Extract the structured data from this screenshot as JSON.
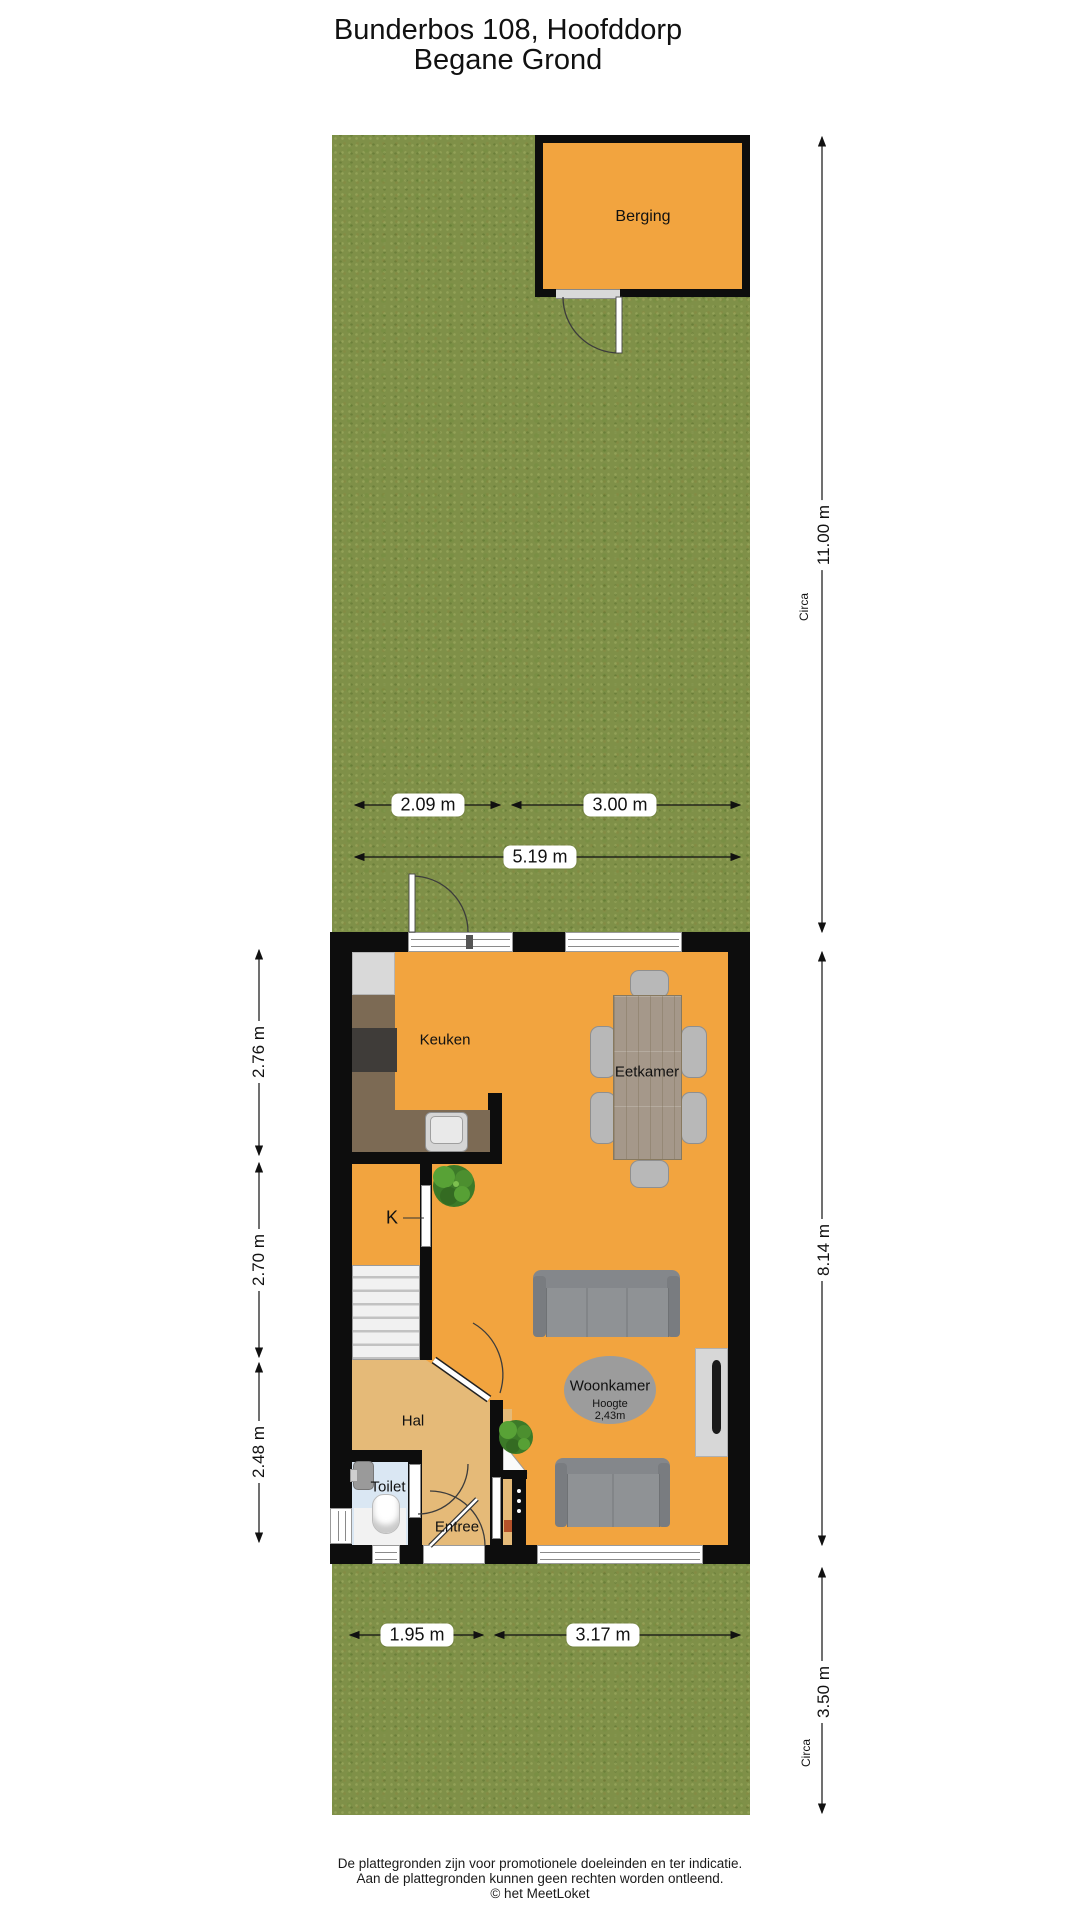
{
  "title": {
    "line1": "Bunderbos 108, Hoofddorp",
    "line2": "Begane Grond"
  },
  "rooms": {
    "berging": "Berging",
    "keuken": "Keuken",
    "eetkamer": "Eetkamer",
    "closet": "K",
    "woonkamer": "Woonkamer",
    "hoogte_label": "Hoogte",
    "hoogte_value": "2,43m",
    "hal": "Hal",
    "toilet": "Toilet",
    "entree": "Entree"
  },
  "dimensions": {
    "garden_top_width_left": "2.09 m",
    "garden_top_width_right": "3.00 m",
    "garden_top_width_total": "5.19 m",
    "left_top": "2.76 m",
    "left_middle": "2.70 m",
    "left_bottom": "2.48 m",
    "right_garden_top": "11.00 m",
    "right_house": "8.14 m",
    "right_garden_bottom": "3.50 m",
    "circa_top": "Circa",
    "circa_bottom": "Circa",
    "garden_bottom_width_left": "1.95 m",
    "garden_bottom_width_right": "3.17 m"
  },
  "footer": {
    "line1": "De plattegronden zijn voor promotionele doeleinden en ter indicatie.",
    "line2": "Aan de plattegronden kunnen geen rechten worden ontleend.",
    "line3": "© het MeetLoket"
  },
  "colors": {
    "floor_orange": "#F2A43F",
    "hal_tan": "#E5BA78",
    "toilet_blue": "#DAE7F3",
    "grass_green": "#7F9048",
    "wall_black": "#0D0D0D"
  }
}
